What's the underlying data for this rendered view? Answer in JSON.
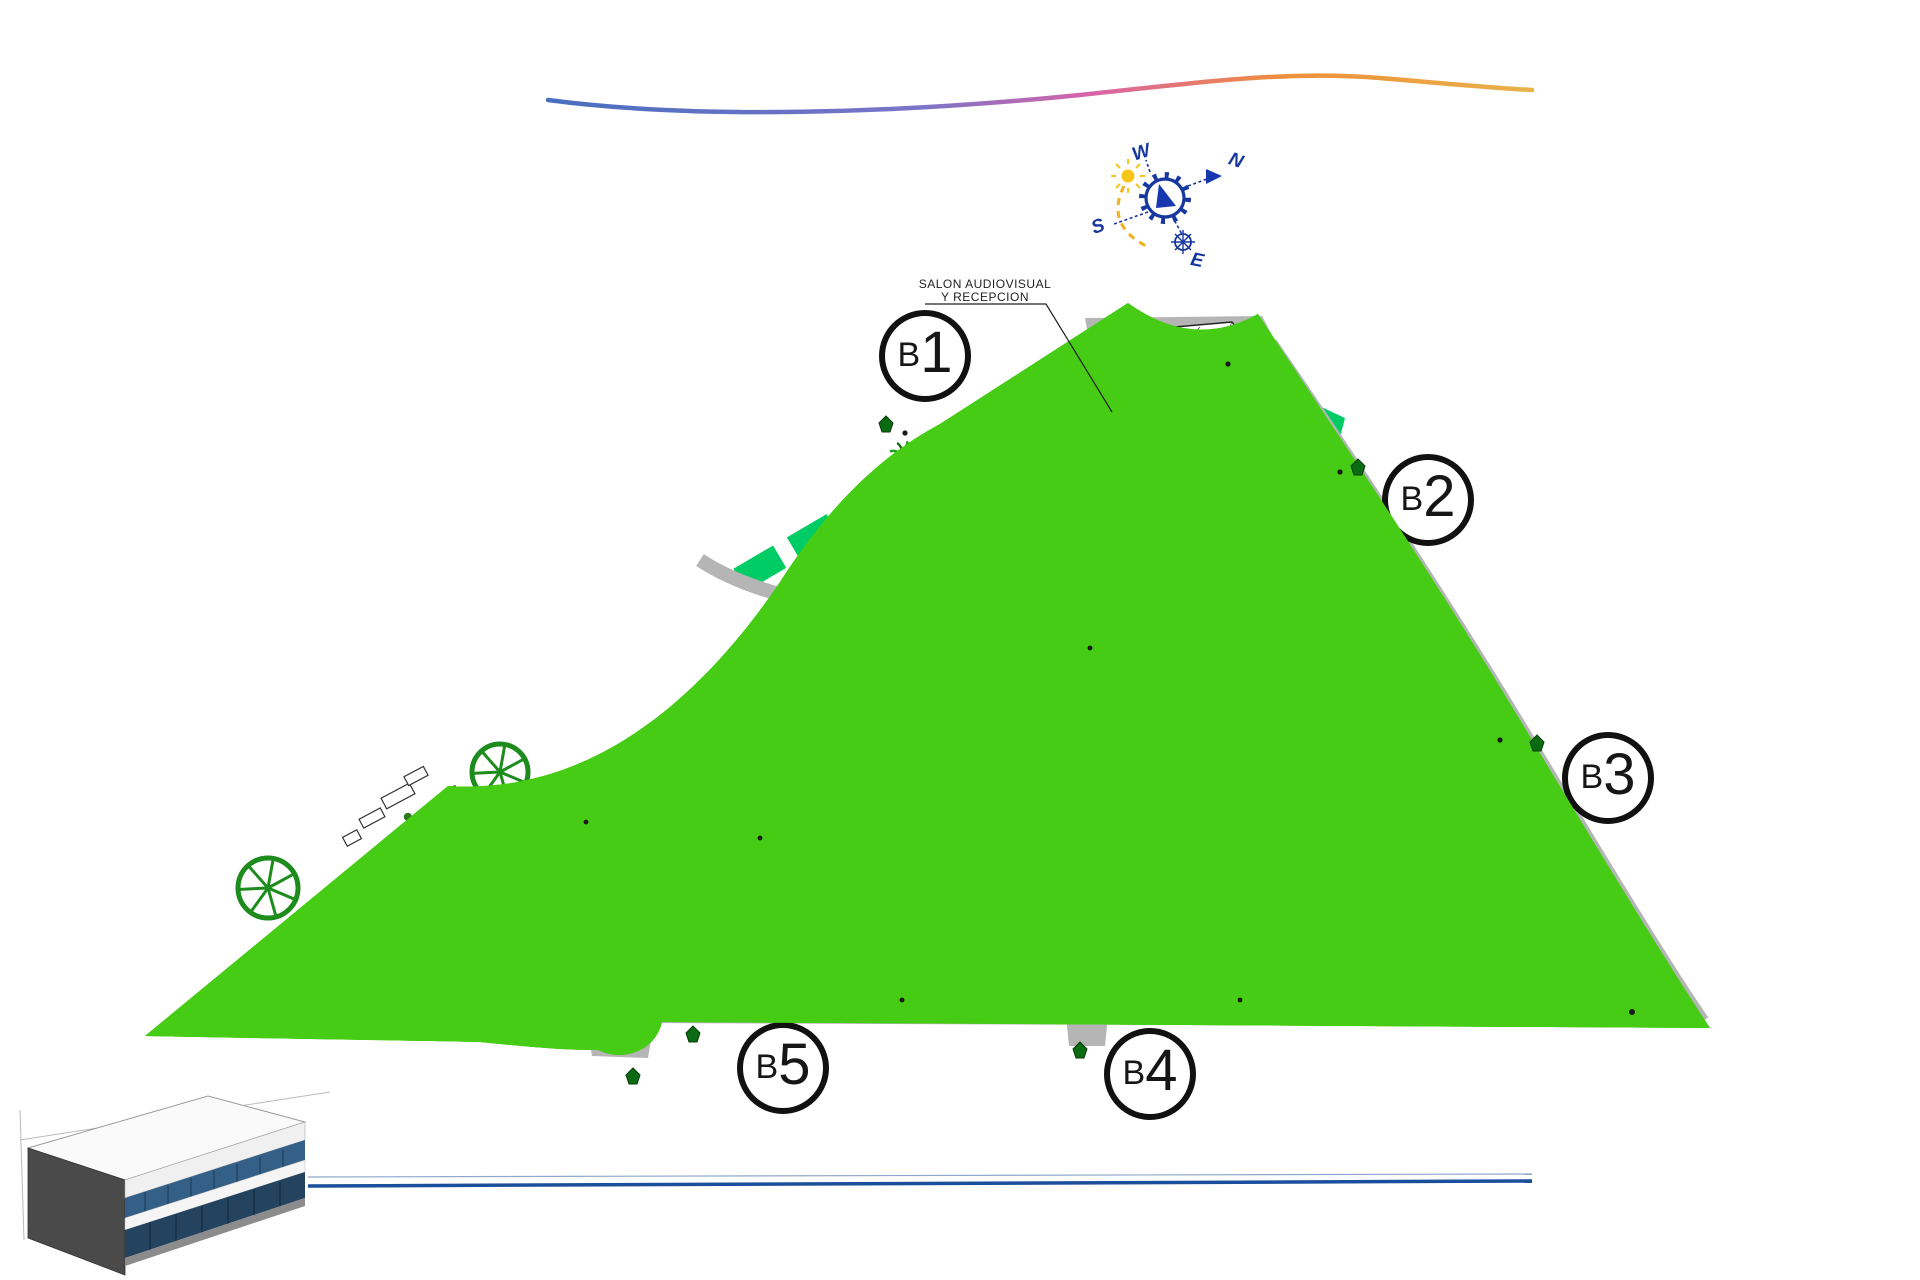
{
  "watermark": {
    "text": "JJ PROPERTIES"
  },
  "compass": {
    "north": "N",
    "south": "S",
    "east": "E",
    "west": "W"
  },
  "annotations": {
    "reception_line1": "SALON AUDIOVISUAL",
    "reception_line2": "Y RECEPCION",
    "petanca": "PETANCA",
    "ping_pong": "PING-PONG",
    "gimnasia": "GIMNASIA",
    "children": "CHILDREN",
    "aseos": "ASEOS"
  },
  "buildings": [
    {
      "id": "b1",
      "label": "B1",
      "units": [
        [
          "01",
          "02",
          "03"
        ],
        [
          "04",
          "05",
          "06"
        ],
        [
          "07",
          "08",
          "09"
        ],
        [
          "10",
          "11",
          "12"
        ],
        [
          "13",
          "14",
          "15"
        ],
        [
          "16",
          "17",
          "18"
        ],
        [
          "19",
          "20",
          "21"
        ]
      ]
    },
    {
      "id": "b2",
      "label": "B2",
      "units": [
        [
          "22",
          "23",
          "24"
        ],
        [
          "25",
          "26",
          "27"
        ],
        [
          "28",
          "29",
          "30"
        ],
        [
          "31",
          "32",
          "33"
        ],
        [
          "34",
          "35",
          "36"
        ],
        [
          "37",
          "38",
          "39"
        ],
        [
          "40",
          "41",
          "42"
        ]
      ]
    },
    {
      "id": "b3",
      "label": "B3",
      "units": [
        [
          "43",
          "44",
          "45"
        ],
        [
          "46",
          "47",
          "48"
        ],
        [
          "49",
          "50",
          "51"
        ],
        [
          "52",
          "53",
          "54"
        ],
        [
          "55",
          "56",
          "57"
        ],
        [
          "58",
          "59",
          "60"
        ],
        [
          "61",
          "62",
          "63"
        ]
      ]
    },
    {
      "id": "b4",
      "label": "B4",
      "units": [
        [
          "84",
          "83",
          "82"
        ],
        [
          "81",
          "80",
          "79"
        ],
        [
          "78",
          "77",
          "76"
        ],
        [
          "75",
          "74",
          "73"
        ],
        [
          "72",
          "71",
          "70"
        ],
        [
          "69",
          "68",
          "67"
        ],
        [
          "66",
          "65",
          "64"
        ]
      ]
    },
    {
      "id": "b5",
      "label": "B5",
      "units": [
        [
          "108",
          "107",
          "106"
        ],
        [
          "105",
          "104",
          "103"
        ],
        [
          "102",
          "101",
          "100"
        ],
        [
          "99",
          "98",
          "97"
        ],
        [
          "96",
          "95",
          "94"
        ],
        [
          "93",
          "92",
          "91"
        ],
        [
          "90",
          "89",
          "88"
        ],
        [
          "87",
          "86",
          "85"
        ]
      ]
    }
  ],
  "colors": {
    "lawn": "#46cc14",
    "garden": "#00cc66",
    "road": "#b5b5b5",
    "boundary": "#b32ddb",
    "unit_number": "#4545cb",
    "pool_water": "#8a93e8",
    "pool_deck": "#f2cf7e",
    "compass_blue": "#16379e",
    "bottom_line_blue": "#1b4e9b"
  }
}
